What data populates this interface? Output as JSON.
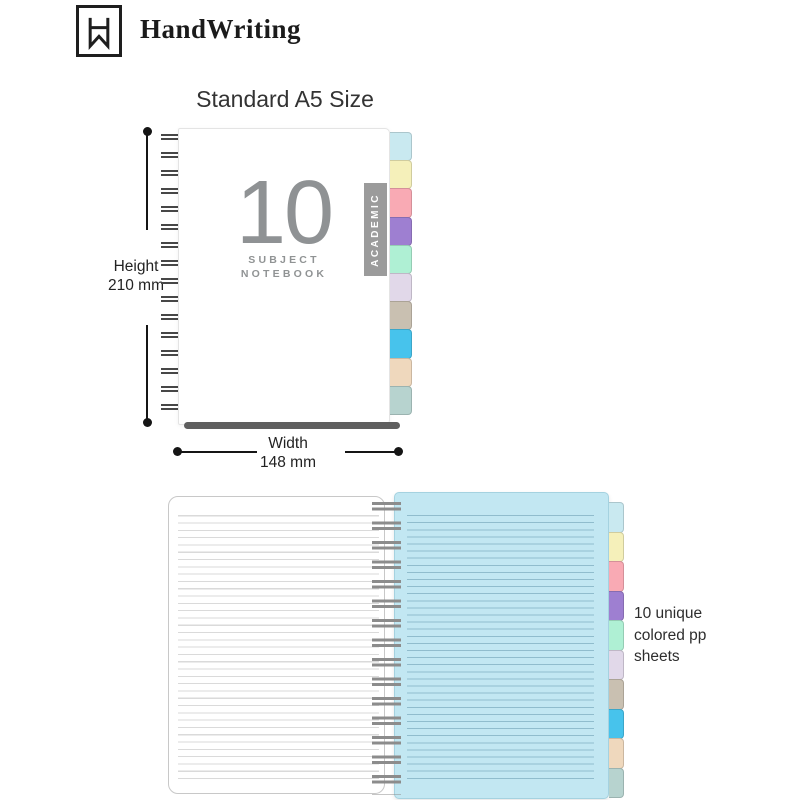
{
  "brand": {
    "name": "HandWriting",
    "logo_icon": "bookmark-monogram-icon"
  },
  "size_section": {
    "title": "Standard A5 Size",
    "cover": {
      "big_number": "10",
      "subject_line1": "SUBJECT",
      "subject_line2": "NOTEBOOK",
      "banner_text": "ACADEMIC"
    },
    "height": {
      "label": "Height",
      "value": "210 mm"
    },
    "width": {
      "label": "Width",
      "value": "148 mm"
    }
  },
  "tabs": {
    "count": 10,
    "colors": [
      "#c9e9f0",
      "#f5f0ba",
      "#f9aab4",
      "#9e7fd1",
      "#aff0d4",
      "#e1d8e9",
      "#c9c0b1",
      "#47c3ec",
      "#efd8bd",
      "#b7d3cf"
    ]
  },
  "open_notebook_section": {
    "note_line1": "10  unique",
    "note_line2": "colored pp",
    "note_line3": "sheets",
    "left_page_color": "#ffffff",
    "right_page_color": "#c2e7f2"
  },
  "colors": {
    "cover_text_gray": "#8f9294",
    "banner_gray": "#9b9b9b",
    "dimension_line": "#151515"
  }
}
